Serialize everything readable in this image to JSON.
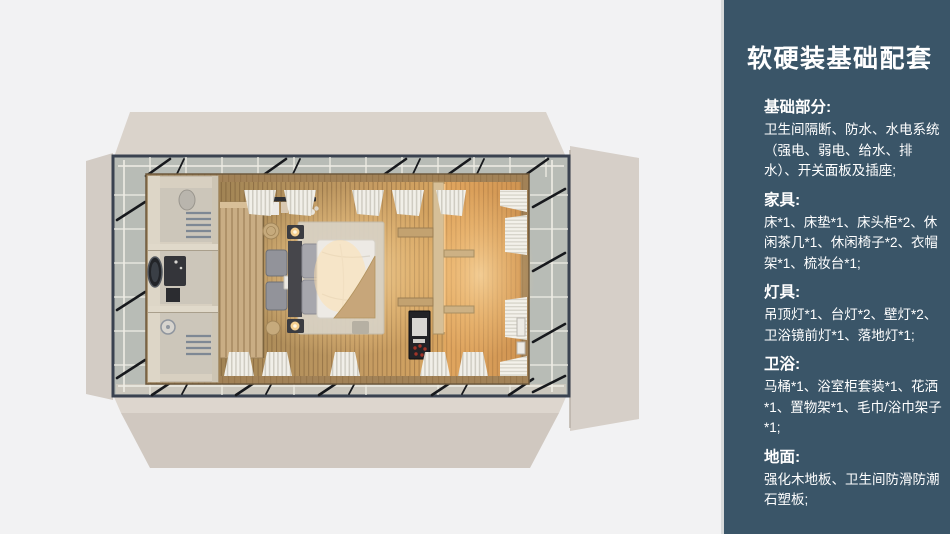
{
  "sidebar": {
    "title": "软硬装基础配套",
    "sections": [
      {
        "heading": "基础部分:",
        "body": "卫生间隔断、防水、水电系统（强电、弱电、给水、排水）、开关面板及插座;"
      },
      {
        "heading": "家具:",
        "body": "床*1、床垫*1、床头柜*2、休闲茶几*1、休闲椅子*2、衣帽架*1、梳妆台*1;"
      },
      {
        "heading": "灯具:",
        "body": "吊顶灯*1、台灯*2、壁灯*2、卫浴镜前灯*1、落地灯*1;"
      },
      {
        "heading": "卫浴:",
        "body": "马桶*1、浴室柜套装*1、花洒*1、置物架*1、毛巾/浴巾架子*1;"
      },
      {
        "heading": "地面:",
        "body": "强化木地板、卫生间防滑防潮石塑板;"
      }
    ]
  },
  "floorplan": {
    "scene": "top-down 3D render of a cabin guest room",
    "elements": [
      "unfolded side panels",
      "steel frame with cross braces",
      "glass perimeter",
      "bathroom block",
      "vanity with round mirror",
      "shower",
      "toilet",
      "towel rack",
      "wood partition",
      "clothes rack",
      "lounge chairs",
      "side table",
      "double bed",
      "pillows",
      "throw blanket",
      "rug",
      "nightstands",
      "table lamps",
      "poufs",
      "shelves",
      "desk",
      "minibar",
      "curtains",
      "wood plank floor"
    ]
  },
  "colors": {
    "background": "#f2f2f3",
    "panel_bg": "#3a5568",
    "panel_text": "#ffffff",
    "panel_edge": "#d7dadb",
    "flap_beige": "#d7d0c8",
    "frame": "#3a4250",
    "floor_wood": "#c29a62",
    "glow": "#ffd592"
  }
}
